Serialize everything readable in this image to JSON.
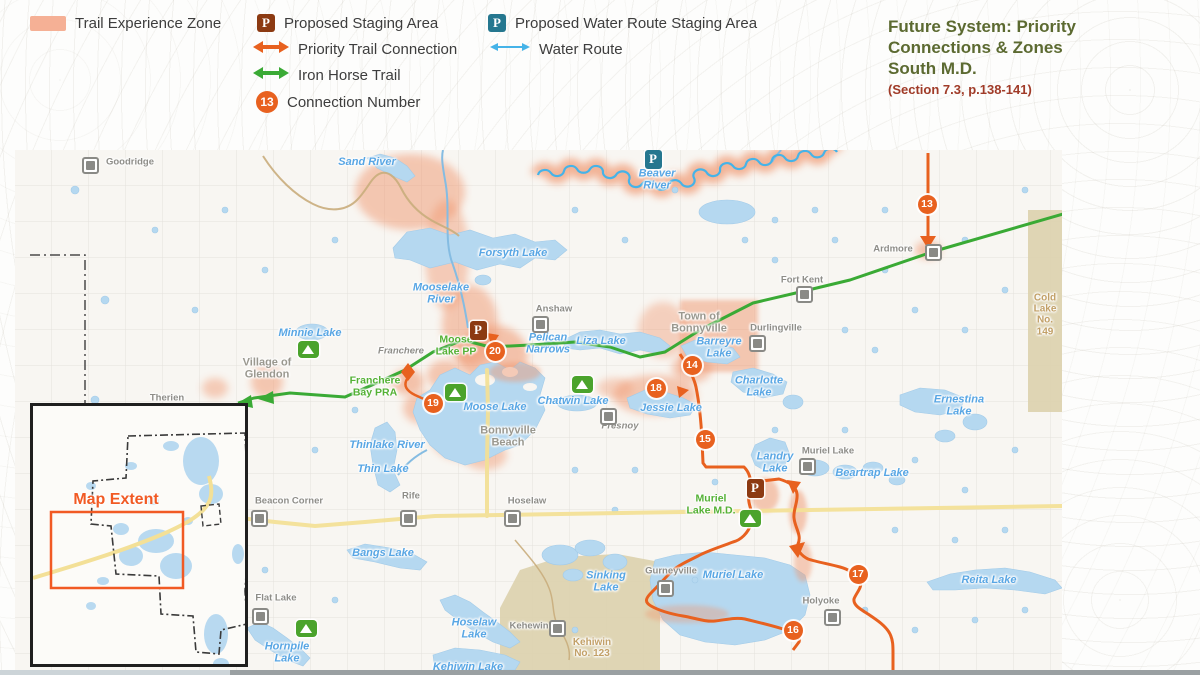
{
  "legend": {
    "trail_experience_zone": "Trail Experience Zone",
    "proposed_staging_area": "Proposed Staging Area",
    "proposed_water_route_staging_area": "Proposed Water Route Staging Area",
    "priority_trail_connection": "Priority Trail Connection",
    "water_route": "Water Route",
    "iron_horse_trail": "Iron Horse Trail",
    "connection_number": "Connection Number",
    "connection_number_sample": "13",
    "p_letter": "P"
  },
  "title": {
    "line1": "Future System: Priority",
    "line2": "Connections & Zones",
    "line3": "South M.D.",
    "subtitle": "(Section 7.3, p.138-141)"
  },
  "colors": {
    "trail_experience_zone": "#f2a47d",
    "priority_trail_connection": "#e8611f",
    "iron_horse_trail": "#3aaa35",
    "water_route": "#45b3e8",
    "proposed_staging": "#8c3a12",
    "proposed_water_staging": "#25778f",
    "lake": "#b5d8f0",
    "reserve_land": "#dcd1ad",
    "title_green": "#5c6a31",
    "subtitle_red": "#a03b28"
  },
  "map": {
    "badges": {
      "b13": "13",
      "b14": "14",
      "b15": "15",
      "b16": "16",
      "b17": "17",
      "b18": "18",
      "b19": "19",
      "b20": "20"
    },
    "markers": {
      "p_letter": "P"
    },
    "inset": {
      "map_extent": "Map Extent"
    },
    "labels": {
      "goodridge": "Goodridge",
      "sand_river": "Sand River",
      "beaver_river": "Beaver\nRiver",
      "ardmore": "Ardmore",
      "cold_lake_reserve": "Cold\nLake\nNo. 149",
      "forsyth_lake": "Forsyth Lake",
      "mooselake_river": "Mooselake\nRiver",
      "anshaw": "Anshaw",
      "fort_kent": "Fort Kent",
      "town_of_bonnyville": "Town of\nBonnyville",
      "durlingville": "Durlingville",
      "barreyre_lake": "Barreyre\nLake",
      "charlotte_lake": "Charlotte\nLake",
      "ernestina_lake": "Ernestina\nLake",
      "minnie_lake": "Minnie Lake",
      "village_of_glendon": "Village of\nGlendon",
      "franchere": "Franchere",
      "moose_lake_pp": "Moose\nLake PP",
      "franchere_bay_pra": "Franchere\nBay PRA",
      "pelican_narrows": "Pelican\nNarrows",
      "liza_lake": "Liza Lake",
      "moose_lake": "Moose Lake",
      "chatwin_lake": "Chatwin Lake",
      "jessie_lake": "Jessie Lake",
      "bonnyville_beach": "Bonnyville\nBeach",
      "fresnoy": "Fresnoy",
      "thinlake_river": "Thinlake River",
      "thin_lake": "Thin Lake",
      "beacon_corner": "Beacon Corner",
      "rife": "Rife",
      "hoselaw": "Hoselaw",
      "bangs_lake": "Bangs Lake",
      "landry_lake": "Landry\nLake",
      "muriel_lake_hamlet": "Muriel Lake",
      "beartrap_lake": "Beartrap Lake",
      "muriel_lake_md": "Muriel\nLake M.D.",
      "gurneyville": "Gurneyville",
      "muriel_lake": "Muriel Lake",
      "holyoke": "Holyoke",
      "reita_lake": "Reita Lake",
      "sinking_lake": "Sinking\nLake",
      "flat_lake": "Flat Lake",
      "hornpile_lake": "Hornpile\nLake",
      "hoselaw_lake": "Hoselaw\nLake",
      "kehewin": "Kehewin",
      "kehiwin_reserve": "Kehiwin\nNo. 123",
      "kehiwin_lake": "Kehiwin Lake",
      "therien": "Therien"
    }
  }
}
